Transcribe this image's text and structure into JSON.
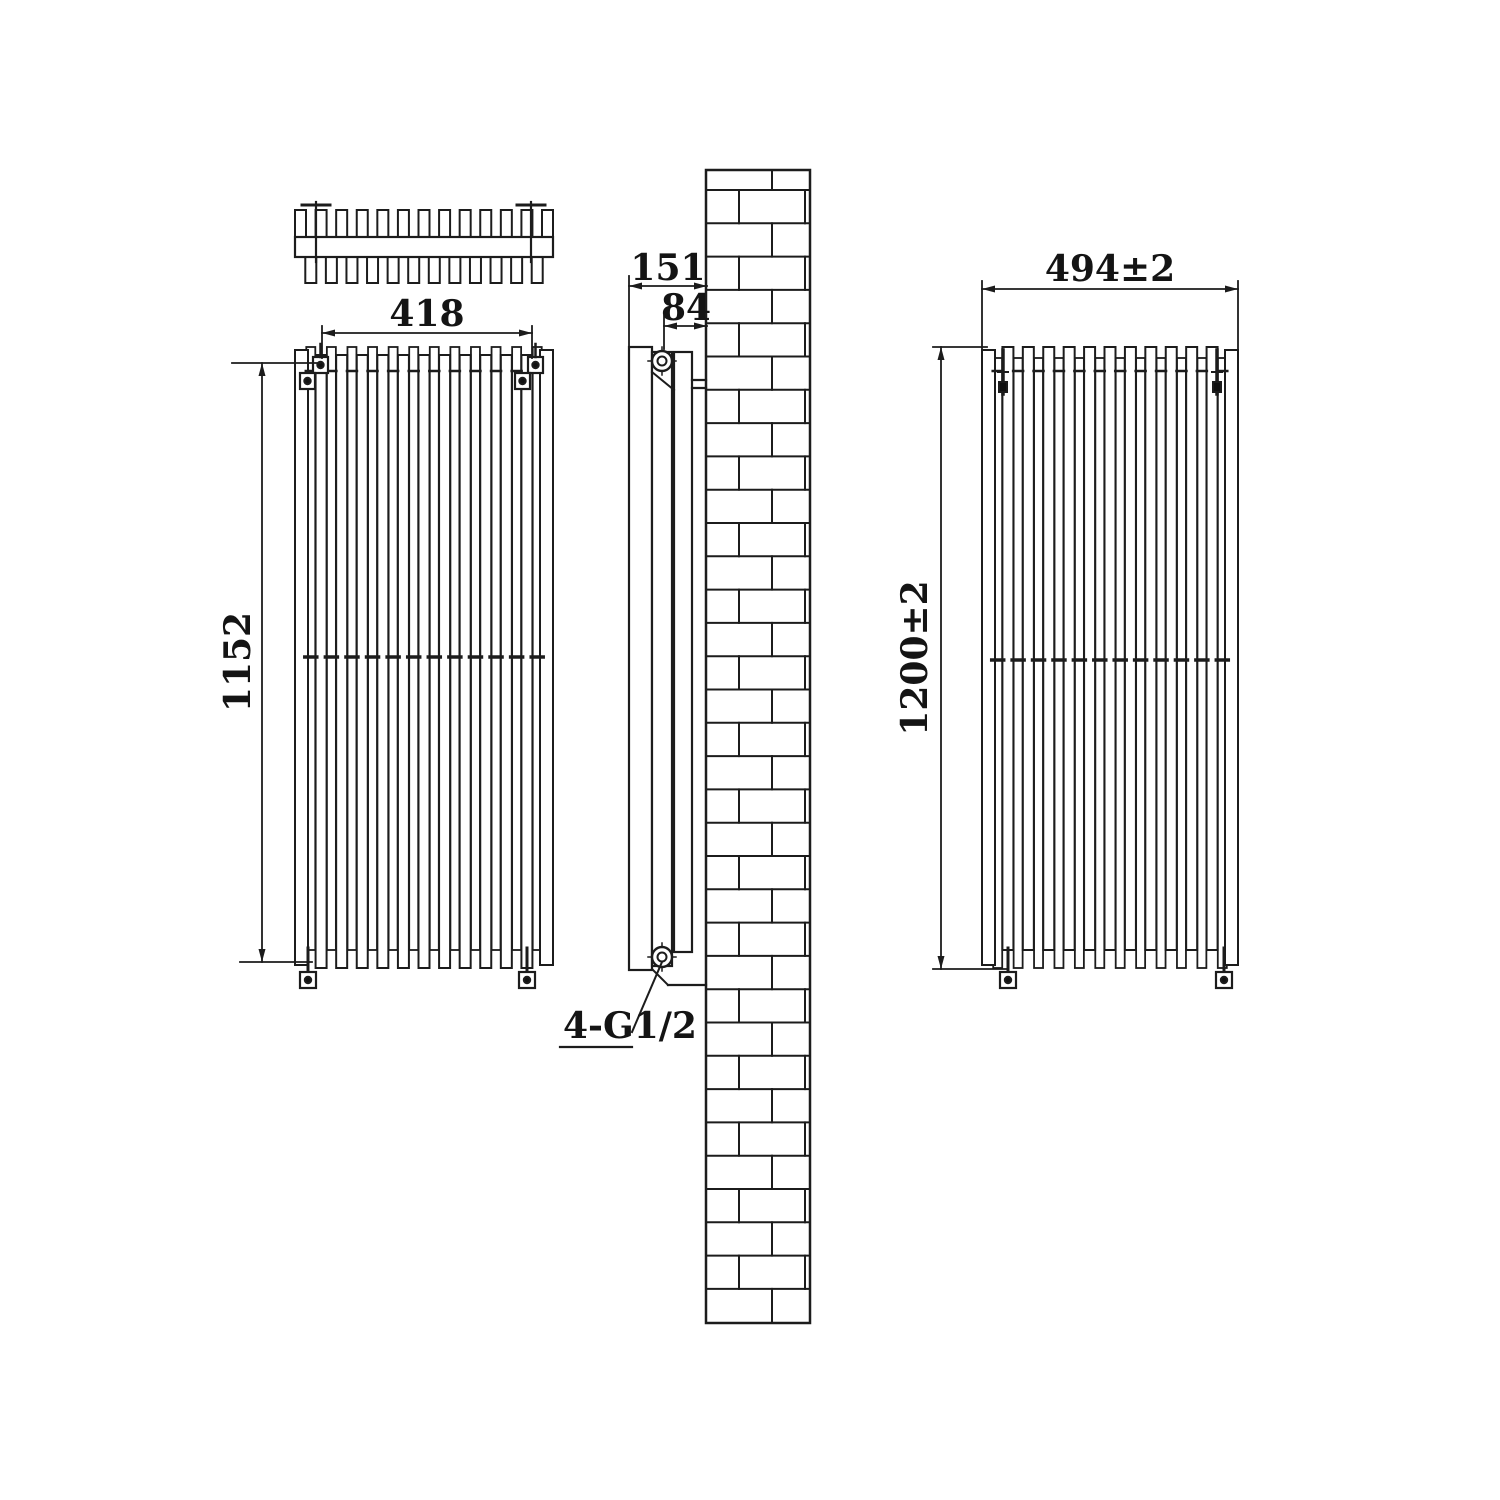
{
  "drawing": {
    "subject": "vertical-column-radiator-installation-drawing",
    "dimensions": {
      "plan_width": "418",
      "front_height": "1152",
      "depth": "151",
      "inlet_offset": "84",
      "connections": "4-G1/2",
      "overall_width": "494±2",
      "overall_height": "1200±2"
    },
    "colors": {
      "line": "#1c1c1c",
      "background": "#ffffff"
    }
  }
}
